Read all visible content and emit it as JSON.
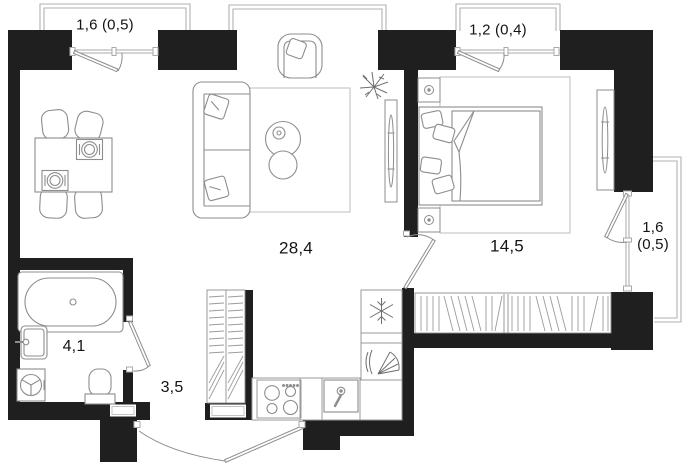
{
  "floorplan": {
    "rooms": [
      {
        "id": "balcony-top-left",
        "area_label": "1,6 (0,5)"
      },
      {
        "id": "balcony-top-right",
        "area_label": "1,2 (0,4)"
      },
      {
        "id": "living-kitchen",
        "area_label": "28,4"
      },
      {
        "id": "bedroom",
        "area_label": "14,5"
      },
      {
        "id": "balcony-right",
        "area_label": "1,6\n(0,5)"
      },
      {
        "id": "bathroom",
        "area_label": "4,1"
      },
      {
        "id": "hallway",
        "area_label": "3,5"
      }
    ],
    "colors": {
      "wall": "#1f1f1f",
      "furniture_line": "#8d8d8d",
      "balcony_line": "#b2b2b2",
      "window_line": "#a8a8a8",
      "hatch_line": "#9c9c9c",
      "background": "#ffffff",
      "label_text": "#141414"
    },
    "furniture_icons": [
      "dining-table",
      "dining-chair",
      "place-setting",
      "sofa",
      "pillow",
      "coffee-table",
      "armchair",
      "tv-stand",
      "plant",
      "bed",
      "nightstand-lamp",
      "wardrobe",
      "bathtub",
      "washbasin",
      "washing-machine",
      "toilet",
      "fridge-snowflake",
      "cooker-hood",
      "stove-burners",
      "kitchen-sink"
    ]
  }
}
